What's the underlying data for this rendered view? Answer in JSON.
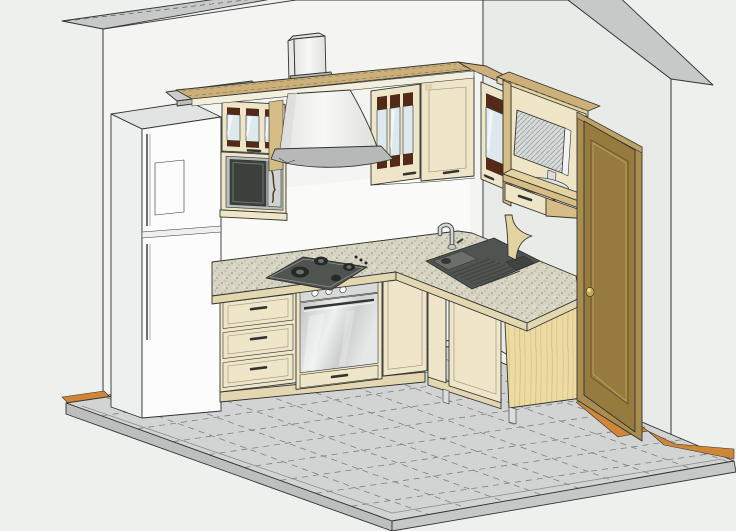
{
  "scene": {
    "type": "3d-kitchen-cad-render",
    "style": "axonometric line rendering, no visible text",
    "objects": [
      "left-wall",
      "right-wall",
      "tiled-floor-platform",
      "wood-threshold-strips",
      "refrigerator-two-door",
      "upper-glass-cabinet-over-microwave",
      "built-in-microwave",
      "chimney-range-hood",
      "wall-cabinet-glass-door",
      "corner-wall-cabinet-solid-door",
      "right-wall-glass-cabinet",
      "tv-shelf-unit-with-drawer",
      "flat-screen-tv",
      "carved-corbel-bracket",
      "wooden-interior-door",
      "door-knob",
      "three-drawer-base-cabinet",
      "gas-cooktop",
      "stainless-oven",
      "base-cabinet-door",
      "speckled-countertop",
      "sink-with-drainboard",
      "chrome-faucet",
      "sink-base-cabinet-doors",
      "plywood-end-panel",
      "cabinet-leg",
      "cornice-shelf"
    ]
  },
  "colors": {
    "bg": "#eef0ee",
    "line": "#32342f",
    "wall-left": "#f4f5f3",
    "wall-right": "#e9ebe9",
    "wall-top": "#c7c9c8",
    "backsplash": "#fafaf8",
    "floor-tile": "#d2d4d3",
    "floor-grout": "#7e817f",
    "floor-bevel": "#bdbfbe",
    "floor-bevel2": "#c6c8c7",
    "wood-floor": "#cf8638",
    "fridge-white": "#fbfcfb",
    "fridge-side": "#eef0ef",
    "fridge-top": "#e2e4e3",
    "cream": "#efe6c9",
    "cream-dark": "#e3d7b2",
    "cream-frame": "#d9cca4",
    "tan-top": "#cdb079",
    "tan-light": "#e3d3a0",
    "tan-mid": "#d6bd85",
    "plywood": "#ecdca4",
    "plywood-grain": "#d0b273",
    "brown-accent": "#53291a",
    "glass-blue": "#dde9ec",
    "appliance-dark": "#4f5451",
    "appliance-mid": "#6a6f6c",
    "steel-light": "#eef0ef",
    "steel-dark": "#bcc0bf",
    "hood-white": "#f3f4f2",
    "hood-rim": "#b6b9b7",
    "door-face": "#967a3e",
    "door-frame": "#a98d50",
    "door-dark": "#6d5729",
    "knob-gold": "#c9a94e",
    "gray-plank": "#cbcdcc"
  }
}
